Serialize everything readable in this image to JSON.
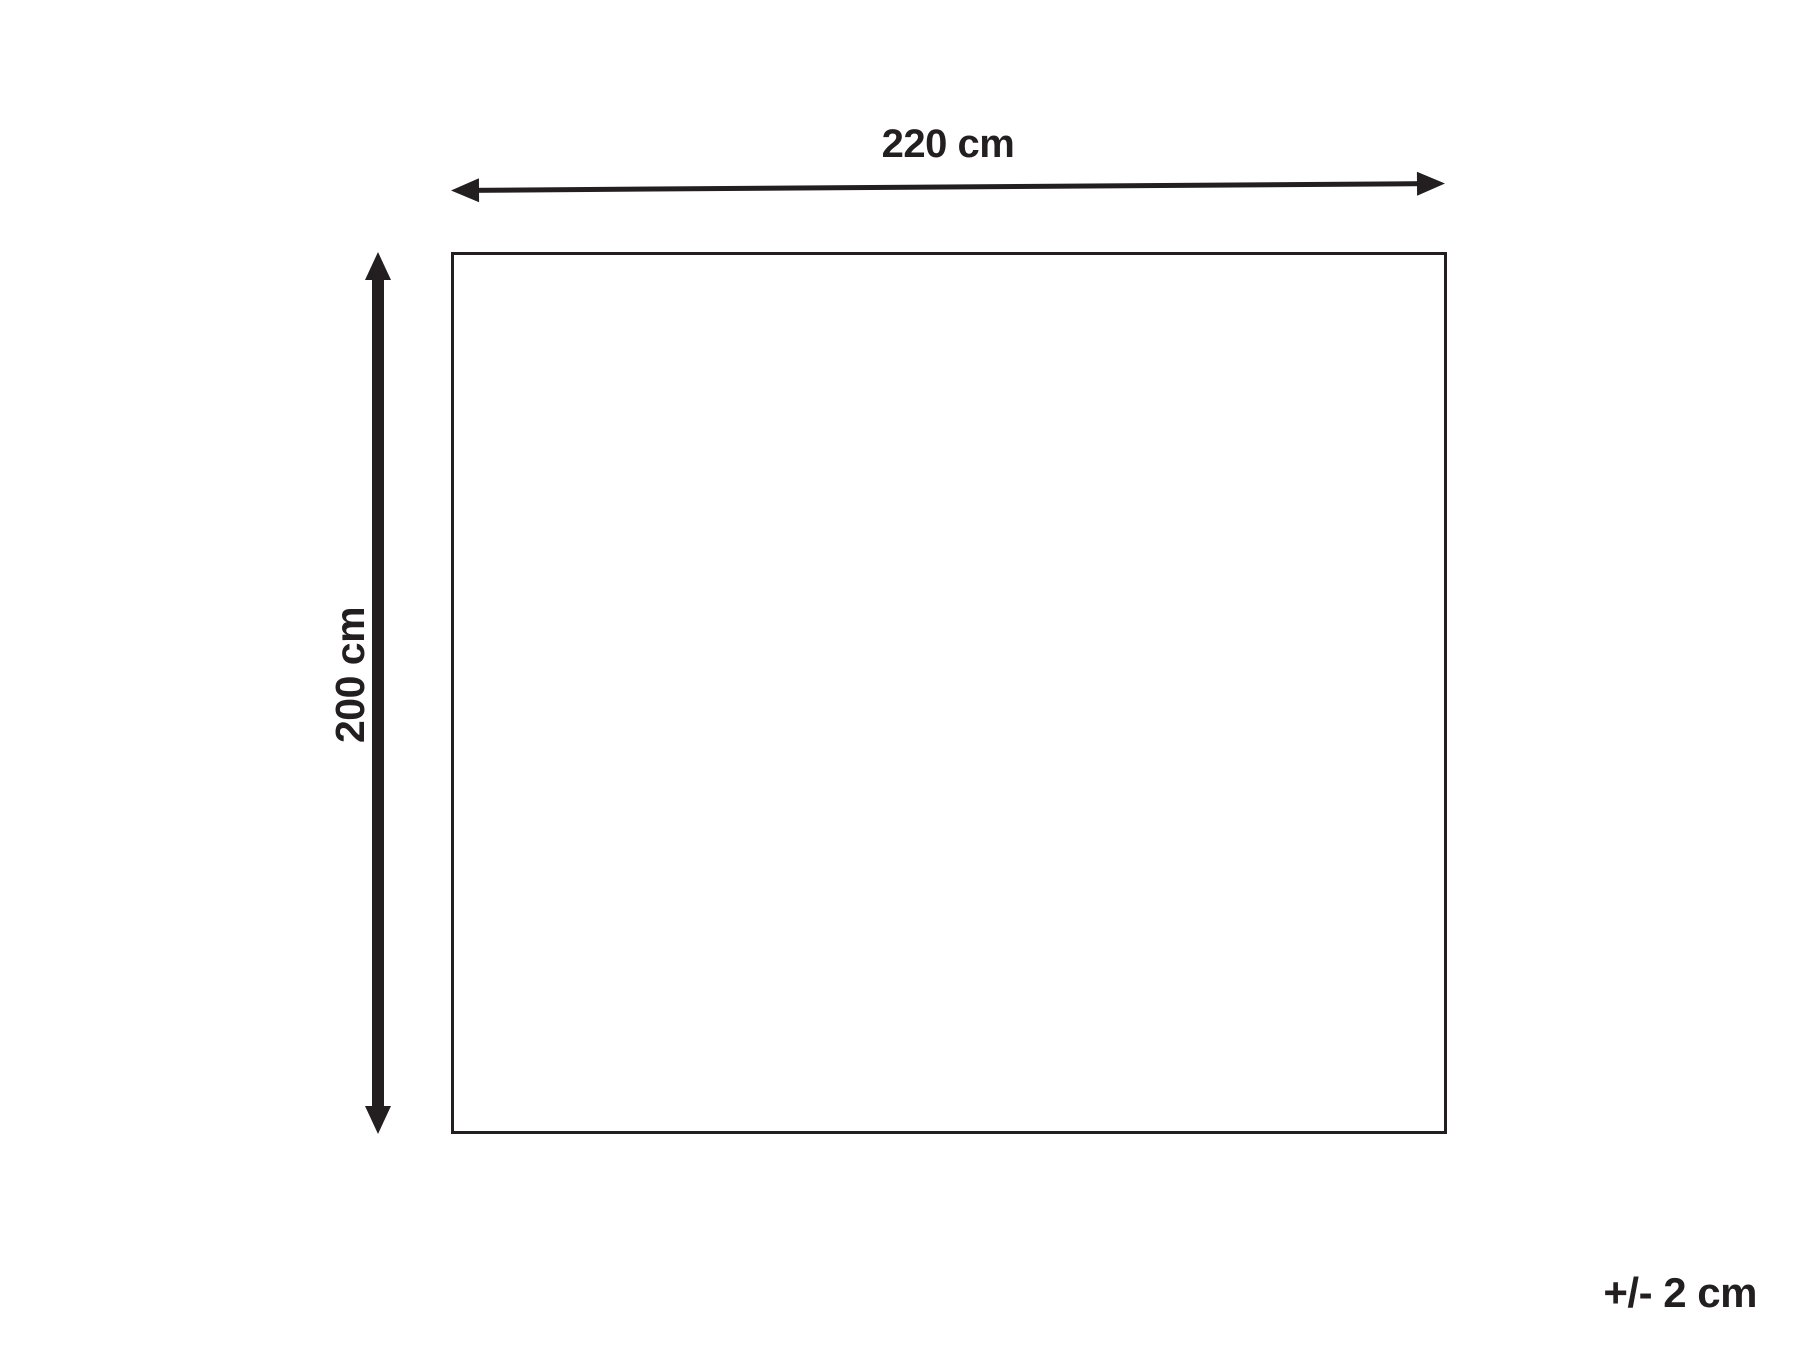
{
  "diagram": {
    "type": "product-dimension-diagram",
    "shape": "rectangle",
    "width_dimension_label": "220 cm",
    "height_dimension_label": "200 cm",
    "tolerance_label": "+/- 2 cm",
    "icons": {
      "width_arrow": "double-headed-horizontal-arrow",
      "height_arrow": "double-headed-vertical-arrow"
    },
    "colors": {
      "line": "#231f20",
      "background": "#ffffff"
    }
  }
}
